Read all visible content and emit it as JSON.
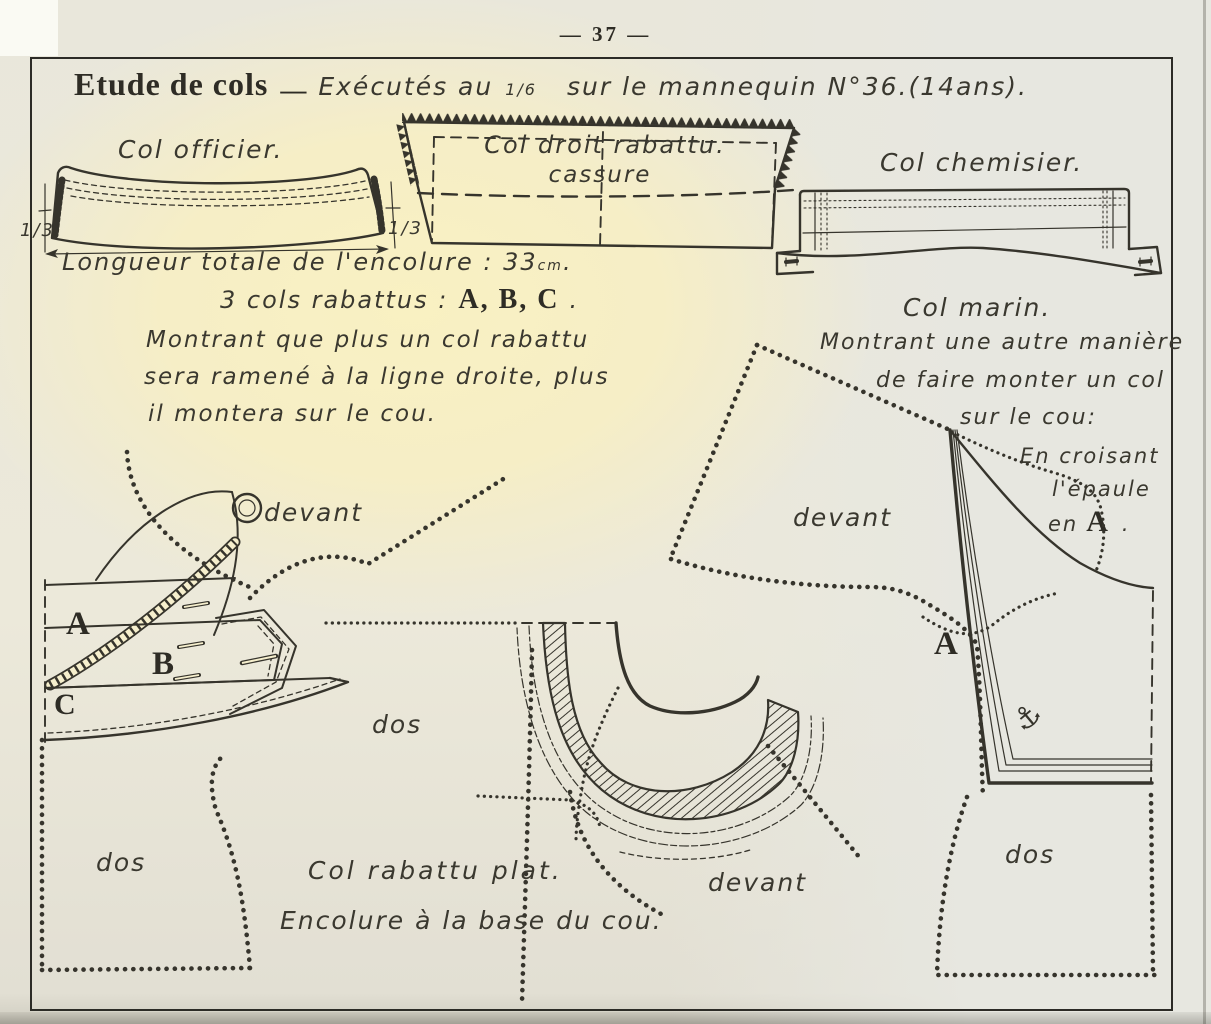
{
  "page": {
    "number": "— 37 —",
    "title": "Etude de cols",
    "title_dash": "—",
    "subtitle_hand": "Exécutés au",
    "subtitle_fraction": "1/6",
    "subtitle_rest": "sur le mannequin N°36.(14ans)."
  },
  "top_row": {
    "officier": {
      "label": "Col officier.",
      "fraction_left": "1/3",
      "fraction_right": "1/3",
      "measure": "Longueur totale de l'encolure : 33",
      "measure_unit": "cm",
      "measure_period": "."
    },
    "droit": {
      "label": "Col droit rabattu.",
      "cassure_label": "cassure"
    },
    "chemisier": {
      "label": "Col chemisier."
    }
  },
  "abc_section": {
    "heading_hand": "3 cols rabattus :",
    "heading_letters": "A, B, C",
    "heading_period": ".",
    "body_line1": "Montrant que plus un col rabattu",
    "body_line2": "sera ramené à la ligne droite, plus",
    "body_line3": "il montera sur le cou.",
    "label_a": "A",
    "label_b": "B",
    "label_c": "C",
    "devant": "devant",
    "dos": "dos"
  },
  "flat_collar_section": {
    "dos": "dos",
    "devant": "devant",
    "caption_line1": "Col rabattu plat.",
    "caption_line2": "Encolure à la base du cou."
  },
  "marin_section": {
    "heading": "Col marin.",
    "body_line1": "Montrant une autre manière",
    "body_line2": "de faire monter un col",
    "body_line3": "sur le cou:",
    "note_line1": "En croisant",
    "note_line2": "l'épaule",
    "note_hand": "en",
    "note_letter": "A",
    "note_period": ".",
    "devant": "devant",
    "label_a": "A",
    "anchor_glyph": "⚓",
    "dos": "dos"
  },
  "colors": {
    "ink": "#36342c",
    "paper_warm": "#f8f0c4",
    "paper_cool": "#e7e7e0"
  }
}
